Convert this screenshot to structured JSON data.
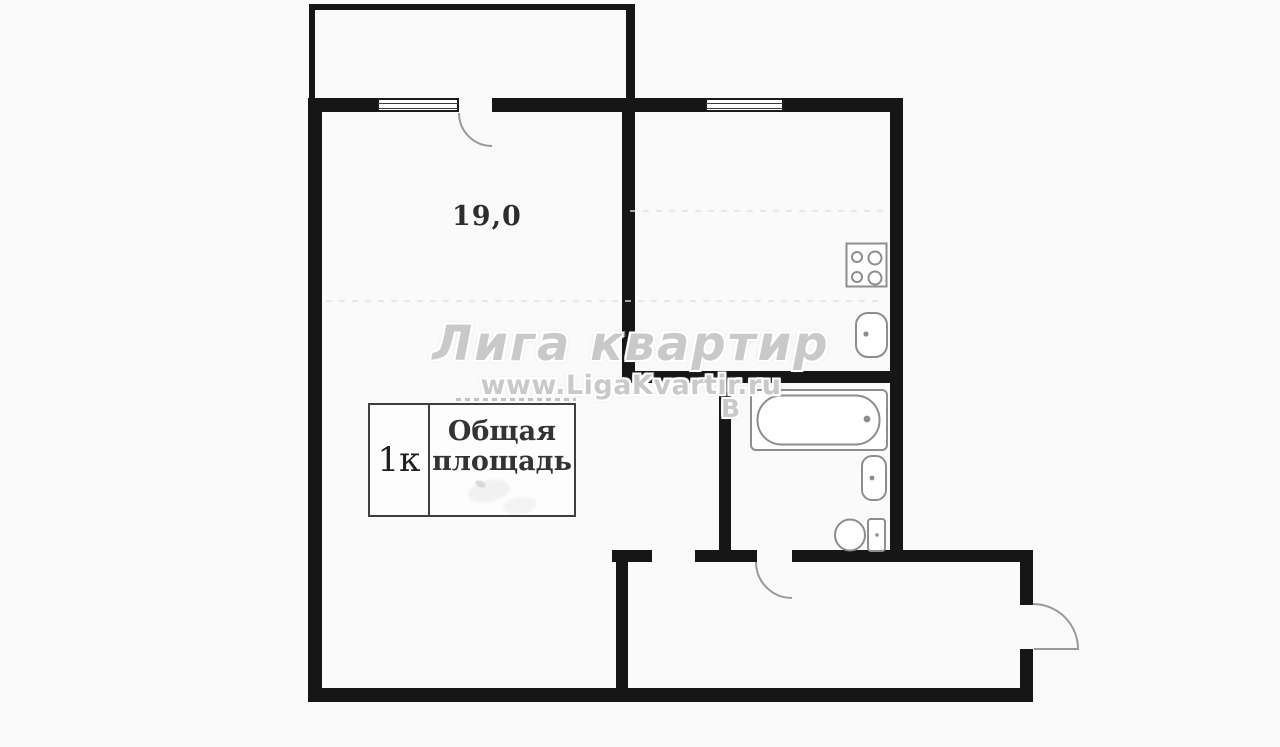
{
  "floorplan": {
    "room_area": "19,0",
    "legend": {
      "rooms": "1к",
      "total_area_line1": "Общая",
      "total_area_line2": "площадь"
    },
    "watermark": {
      "brand": "Лига квартир",
      "website": "www.LigaKvartir.ru",
      "stray_letter": "В"
    },
    "colors": {
      "background": "#fafafa",
      "wall": "#161616",
      "fixture": "#8d8d8d",
      "watermark": "#c9c9c9",
      "text": "#2d2d2d"
    },
    "icons": {
      "window-icon": "double-line sill rectangle",
      "door-arc-icon": "quarter-circle swing line",
      "stove-icon": "square with 4 burner circles",
      "kitchen-sink-icon": "rounded rectangle with drain dot",
      "bathtub-icon": "rect with inner capsule and drain dot",
      "washbasin-icon": "rounded basin with dot",
      "toilet-icon": "oval bowl with tank"
    }
  }
}
